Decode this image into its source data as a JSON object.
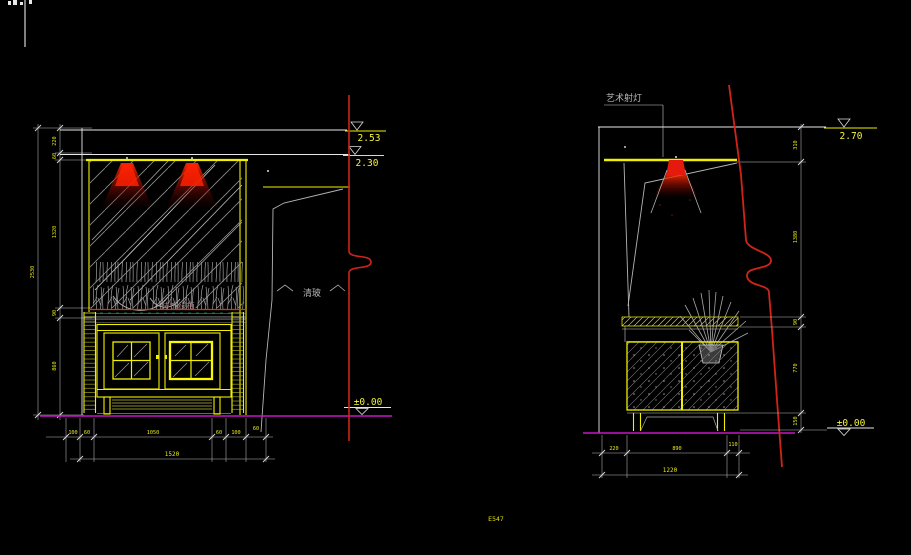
{
  "colors": {
    "background": "#000000",
    "line_white": "#e8e8e8",
    "dimension_yellow": "#f0f000",
    "section_line_red": "#d02418",
    "floor_line_magenta": "#c816c8",
    "lamp_glow_red": "#ff2000",
    "hatch_gray": "#8f8f8f"
  },
  "left": {
    "levels": {
      "upper": "2.53",
      "lower": "2.30",
      "floor": "±0.00"
    },
    "notes": {
      "plant": "装饰绿植",
      "glass": "清玻"
    },
    "dims": {
      "v_total": "2530",
      "v_segments": [
        "220",
        "60",
        "1320",
        "90",
        "860"
      ],
      "b_row": [
        "100",
        "60",
        "1050",
        "60",
        "100",
        "60"
      ],
      "b_total": "1520"
    }
  },
  "right": {
    "levels": {
      "top": "2.70",
      "floor": "±0.00"
    },
    "notes": {
      "light": "艺术射灯"
    },
    "dims": {
      "v_segments": [
        "310",
        "1380",
        "90",
        "770",
        "150"
      ],
      "b_row": [
        "220",
        "890",
        "110"
      ],
      "b_total": "1220"
    }
  },
  "misc": {
    "corner_note": "E547"
  }
}
